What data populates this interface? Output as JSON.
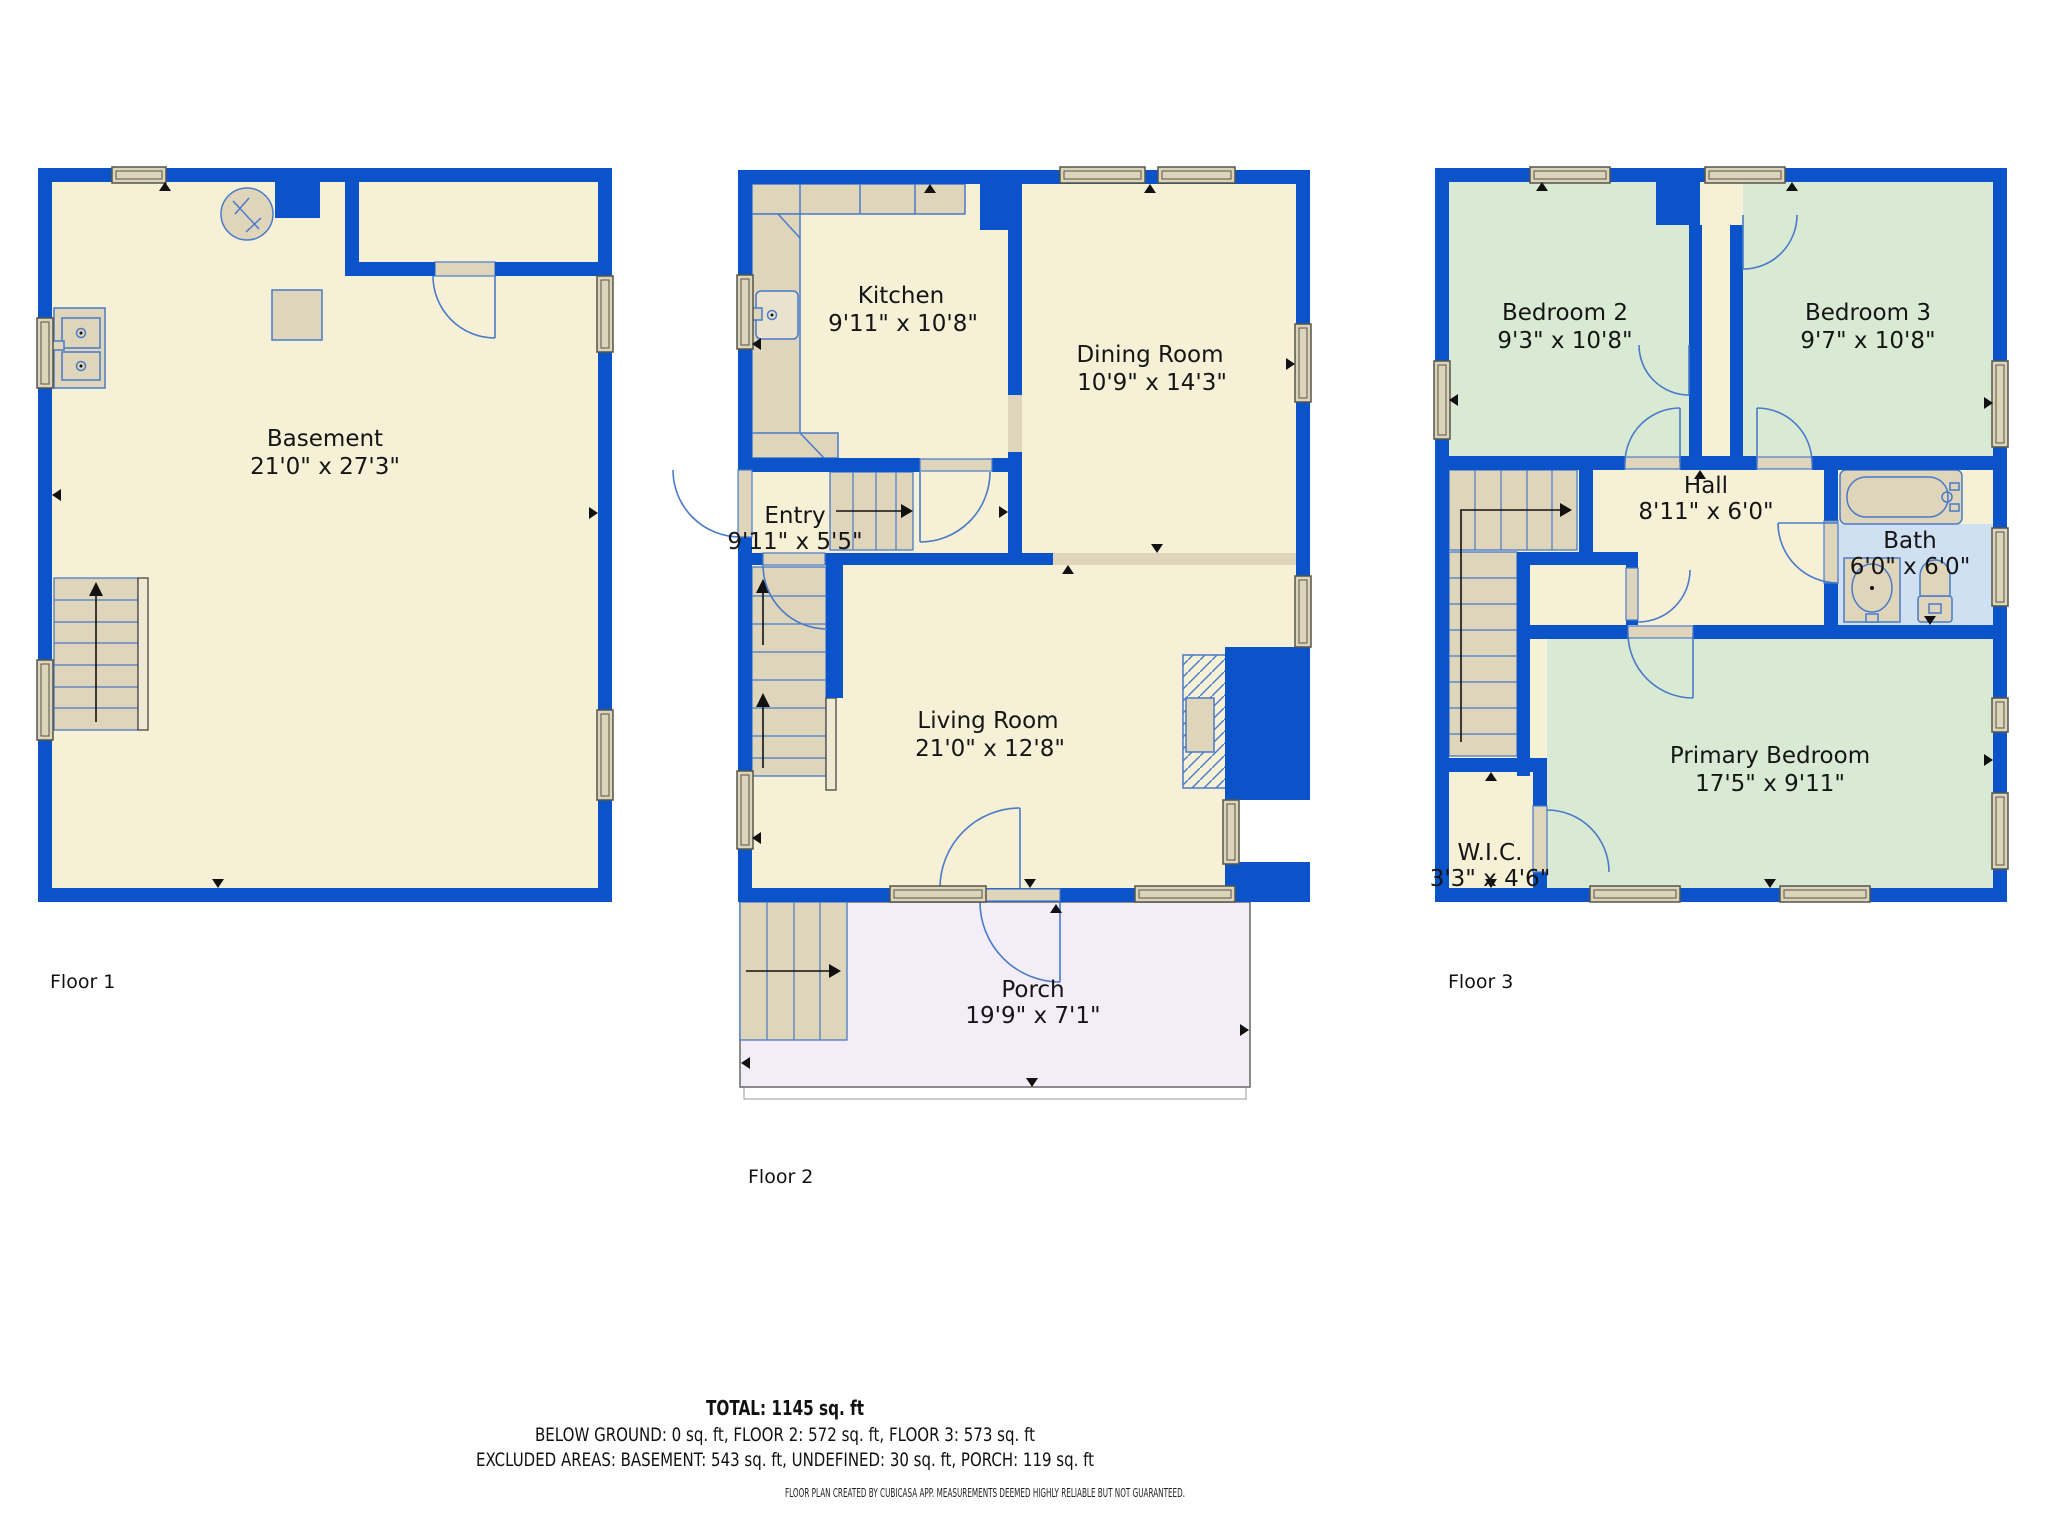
{
  "floors": [
    {
      "label": "Floor 1",
      "rooms": [
        {
          "name": "Basement",
          "dims": "21'0\" x 27'3\""
        }
      ]
    },
    {
      "label": "Floor 2",
      "rooms": [
        {
          "name": "Kitchen",
          "dims": "9'11\" x 10'8\""
        },
        {
          "name": "Dining Room",
          "dims": "10'9\" x 14'3\""
        },
        {
          "name": "Entry",
          "dims": "9'11\" x 5'5\""
        },
        {
          "name": "Living Room",
          "dims": "21'0\" x 12'8\""
        },
        {
          "name": "Porch",
          "dims": "19'9\" x 7'1\""
        }
      ]
    },
    {
      "label": "Floor 3",
      "rooms": [
        {
          "name": "Bedroom 2",
          "dims": "9'3\" x 10'8\""
        },
        {
          "name": "Bedroom 3",
          "dims": "9'7\" x 10'8\""
        },
        {
          "name": "Hall",
          "dims": "8'11\" x 6'0\""
        },
        {
          "name": "Bath",
          "dims": "6'0\" x 6'0\""
        },
        {
          "name": "Primary Bedroom",
          "dims": "17'5\" x 9'11\""
        },
        {
          "name": "W.I.C.",
          "dims": "3'3\" x 4'6\""
        }
      ]
    }
  ],
  "summary": {
    "total": "TOTAL: 1145 sq. ft",
    "by_floor": "BELOW GROUND: 0 sq. ft, FLOOR 2: 572 sq. ft, FLOOR 3: 573 sq. ft",
    "excluded": "EXCLUDED AREAS: BASEMENT: 543 sq. ft, UNDEFINED: 30 sq. ft, PORCH: 119 sq. ft",
    "disclaimer": "FLOOR PLAN CREATED BY CUBICASA APP. MEASUREMENTS DEEMED HIGHLY RELIABLE BUT NOT GUARANTEED."
  },
  "colors": {
    "wall": "#0A53C9",
    "floor_cream": "#F5F0D6",
    "bedroom_green": "#D8EAD3",
    "bath_blue": "#CEE0F2",
    "porch_lavender": "#F2EDF6",
    "fixture_tan": "#DED5BA",
    "fixture_outline": "#4A7AC8",
    "text": "#151515"
  },
  "icons": {
    "water_heater": "water-heater-icon",
    "furnace": "furnace-icon",
    "laundry_sink": "laundry-sink-icon",
    "kitchen_sink": "kitchen-sink-icon",
    "bathtub": "bathtub-icon",
    "toilet": "toilet-icon",
    "vanity_sink": "vanity-sink-icon",
    "fireplace": "fireplace-icon",
    "stairs": "stairs-icon",
    "door": "door-arc-icon",
    "window": "window-icon"
  }
}
